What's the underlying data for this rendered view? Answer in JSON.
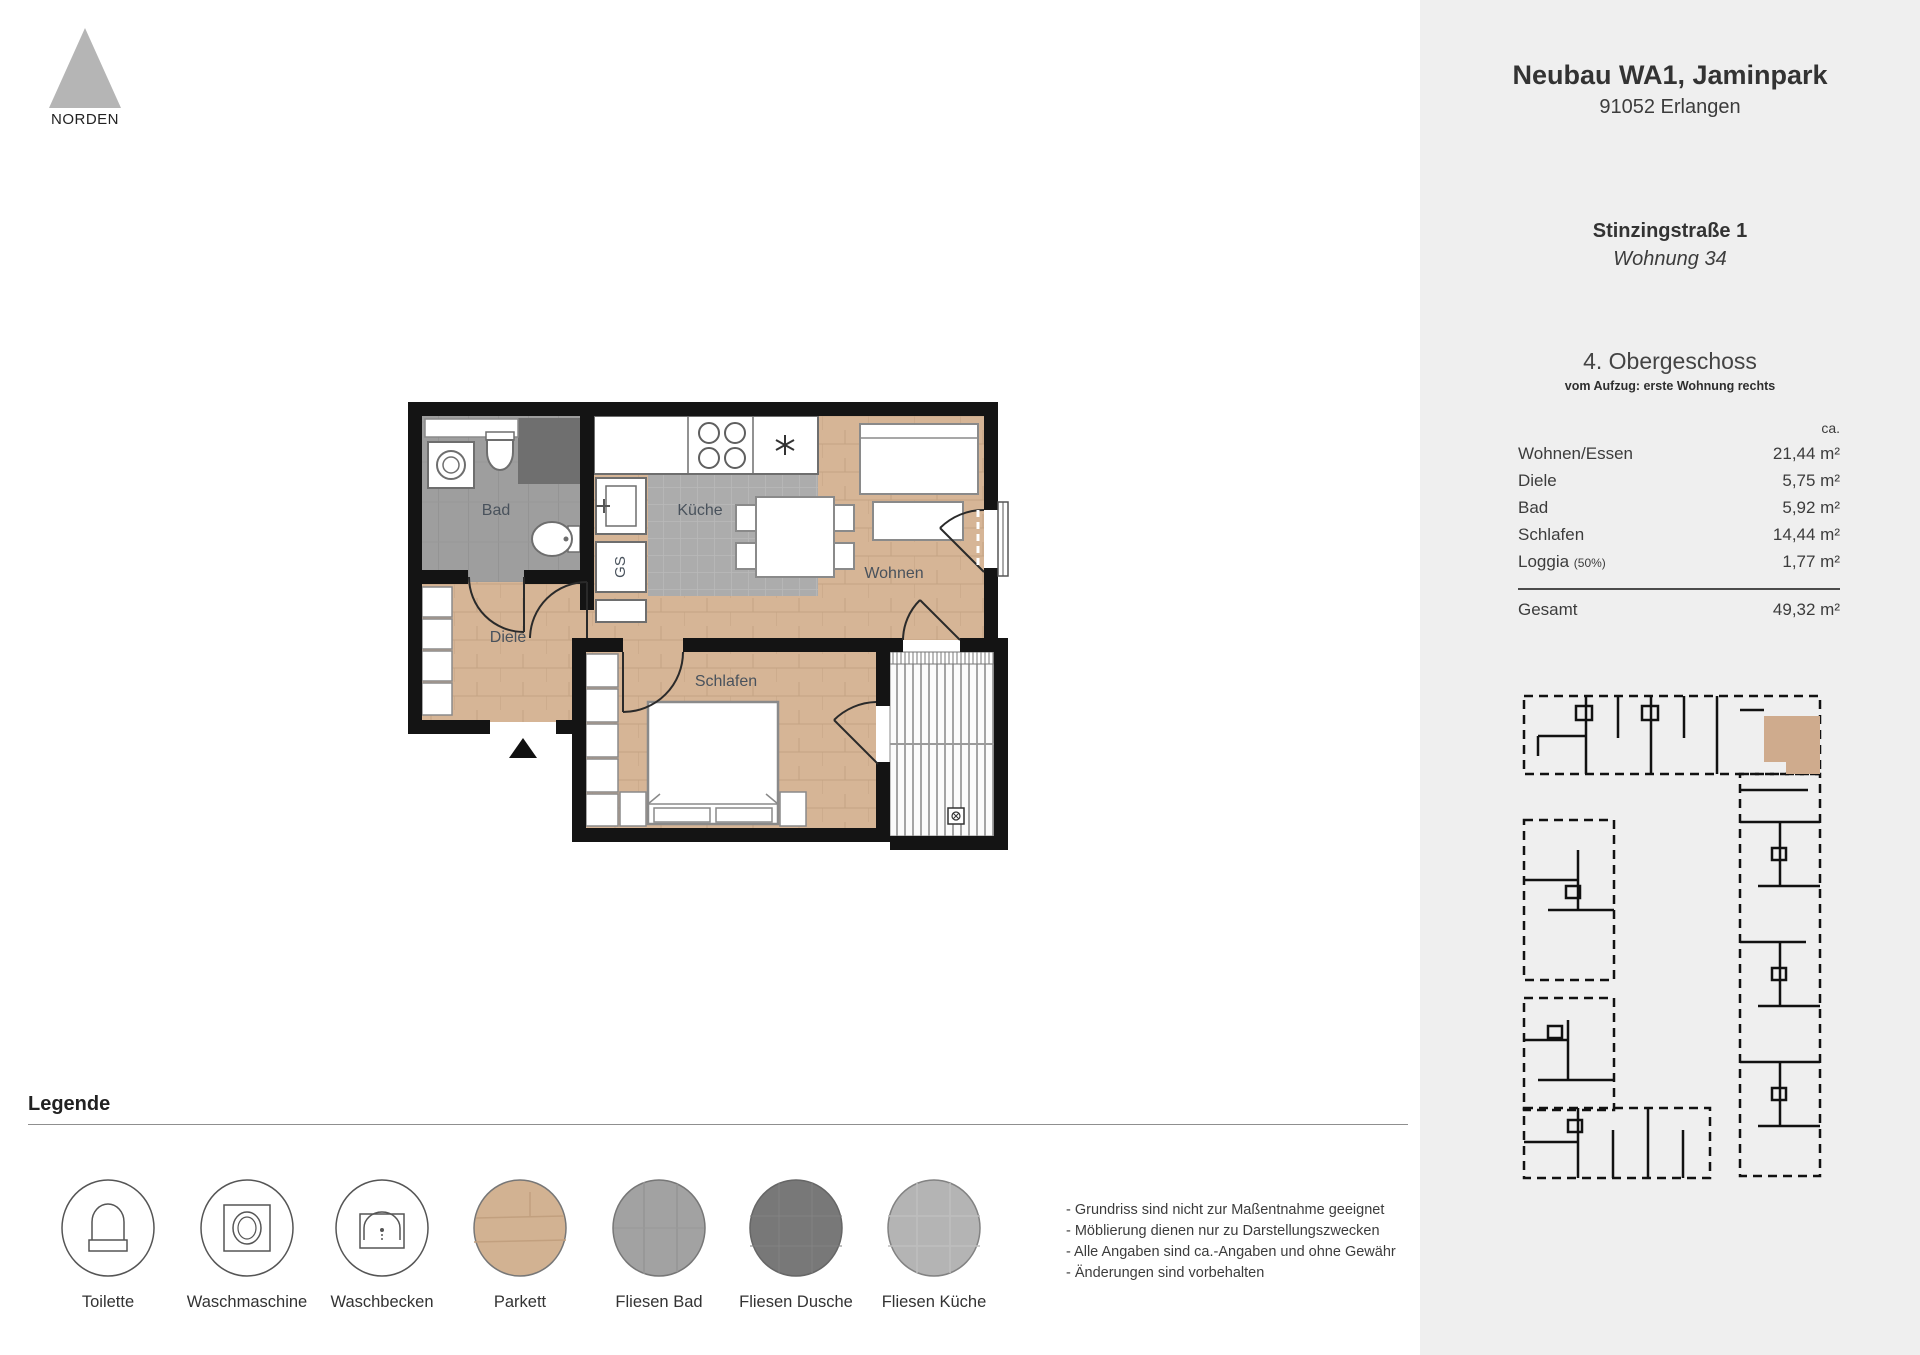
{
  "north": {
    "label": "NORDEN"
  },
  "project": {
    "title": "Neubau WA1, Jaminpark",
    "city": "91052 Erlangen",
    "street": "Stinzingstraße 1",
    "unit": "Wohnung 34",
    "floor": "4. Obergeschoss",
    "floor_note": "vom Aufzug: erste Wohnung rechts"
  },
  "areas": {
    "ca_label": "ca.",
    "rows": [
      {
        "label": "Wohnen/Essen",
        "value": "21,44 m²"
      },
      {
        "label": "Diele",
        "value": "5,75 m²"
      },
      {
        "label": "Bad",
        "value": "5,92 m²"
      },
      {
        "label": "Schlafen",
        "value": "14,44 m²"
      },
      {
        "label": "Loggia",
        "label_suffix": "(50%)",
        "value": "1,77 m²"
      }
    ],
    "total": {
      "label": "Gesamt",
      "value": "49,32 m²"
    }
  },
  "plan": {
    "rooms": {
      "bad": "Bad",
      "kueche": "Küche",
      "wohnen": "Wohnen",
      "diele": "Diele",
      "schlafen": "Schlafen"
    },
    "fixtures": {
      "gs": "GS"
    }
  },
  "legend": {
    "title": "Legende",
    "items": [
      {
        "icon": "toilet-icon",
        "label": "Toilette"
      },
      {
        "icon": "washing-machine-icon",
        "label": "Waschmaschine"
      },
      {
        "icon": "sink-icon",
        "label": "Waschbecken"
      },
      {
        "icon": "parquet-swatch",
        "label": "Parkett"
      },
      {
        "icon": "tiles-bath-swatch",
        "label": "Fliesen Bad"
      },
      {
        "icon": "tiles-shower-swatch",
        "label": "Fliesen Dusche"
      },
      {
        "icon": "tiles-kitchen-swatch",
        "label": "Fliesen Küche"
      }
    ]
  },
  "notes": [
    "- Grundriss sind nicht zur Maßentnahme geeignet",
    "- Möblierung dienen nur zu Darstellungszwecken",
    "- Alle Angaben sind ca.-Angaben und ohne Gewähr",
    "- Änderungen sind vorbehalten"
  ],
  "colors": {
    "wall": "#141414",
    "wood": "#d6b596",
    "tile_bath": "#9e9e9e",
    "tile_shower": "#6f6f6f",
    "tile_kitchen": "#acacac",
    "sidebar_bg": "#efefef",
    "highlight_unit": "#cfab8d"
  }
}
